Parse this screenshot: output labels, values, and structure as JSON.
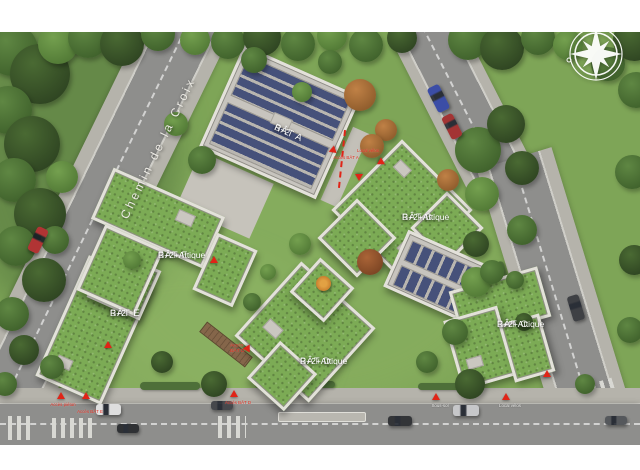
{
  "street": {
    "name": "Chemin de la Croix"
  },
  "buildings": {
    "a": {
      "name": "BÂT A",
      "floors": "R+2"
    },
    "b": {
      "name": "BÂT B",
      "floors": "R+2+Attique"
    },
    "c": {
      "name": "BÂT C",
      "floors": "R+2+Attique"
    },
    "d": {
      "name": "BÂT D",
      "floors": "R+2+Attique"
    },
    "e": {
      "name": "BÂT E",
      "floors": "R+2"
    },
    "f": {
      "name": "BÂT F",
      "floors": "R+2+Attique"
    }
  },
  "markers": {
    "bat_a_access": "Accès BÂT A",
    "bat_ab_velos": "Local vélos",
    "bat_d_path_l1": "Accès",
    "bat_d_path_l2": "BÂT D",
    "bottom_1": "Accès piéton",
    "bottom_2": "Accès BÂT E",
    "bottom_3": "Accès BÂT D",
    "bottom_4": "Sous-sol",
    "bottom_5": "Local vélos"
  },
  "colors": {
    "marker_red": "#e02417",
    "green_roof": "#7cab55",
    "solar_panel": "#46517a",
    "lawn": "#7ea557",
    "asphalt": "#8e8e8c"
  }
}
